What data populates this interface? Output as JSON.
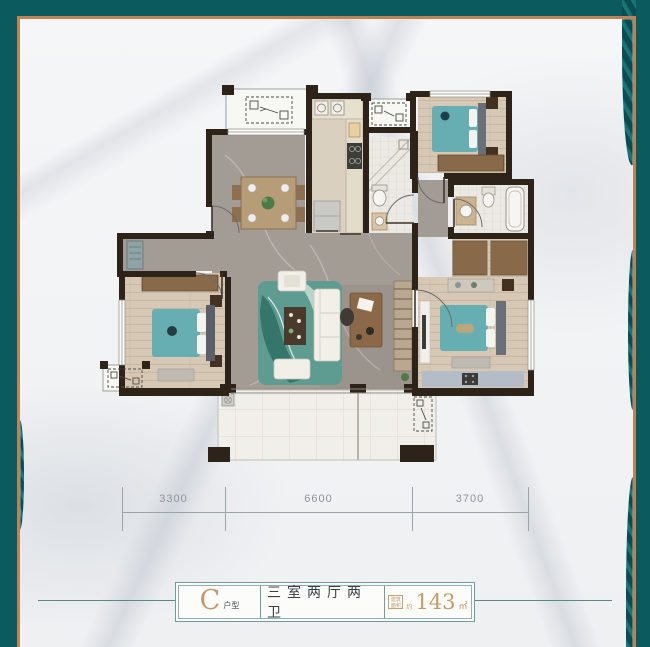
{
  "colors": {
    "frame_teal": "#0b5a5e",
    "frame_copper": "#c08252",
    "gold": "#c49b66",
    "wall": "#2e2319",
    "dim_text": "#8d9496",
    "card_border": "#6f9c9a",
    "extension_line": "#5b8886",
    "bed_teal": "#67aeb2",
    "rug_teal": "#4f9187"
  },
  "dimensions": {
    "segments": [
      {
        "label": "3300"
      },
      {
        "label": "6600"
      },
      {
        "label": "3700"
      }
    ]
  },
  "card": {
    "type_letter": "C",
    "type_suffix": "户型",
    "rooms_text": "三室两厅两卫",
    "area_badge_line1": "建筑",
    "area_badge_line2": "面积",
    "area_prefix": "约",
    "area_value": "143",
    "area_unit": "㎡"
  },
  "icons": {
    "ac_unit": "air-conditioner-platform-symbol",
    "floor_drain": "floor-drain-symbol"
  }
}
